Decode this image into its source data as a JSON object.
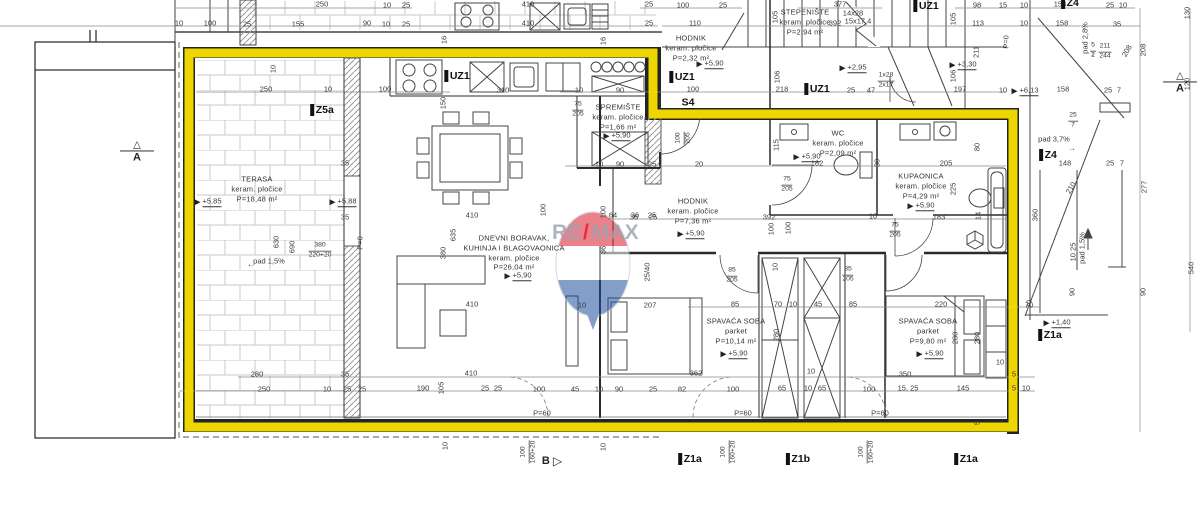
{
  "watermark": {
    "re": "RE",
    "slash": "/",
    "max": "MAX",
    "red": "#dc1c2e",
    "blue": "#1d4f9e",
    "gray": "#9aa2ad"
  },
  "highlight_color": "#ffe600",
  "rooms": [
    {
      "x": 257,
      "y": 189,
      "lines": [
        "TERASA",
        "keram. pločice",
        "P=18,48 m²"
      ]
    },
    {
      "x": 514,
      "y": 253,
      "lines": [
        "DNEVNI BORAVAK,",
        "KUHINJA I BLAGOVAONICA",
        "keram. pločice",
        "P=26,04 m²"
      ]
    },
    {
      "x": 618,
      "y": 117,
      "lines": [
        "SPREMIŠTE",
        "keram. pločice",
        "P=1,66 m²"
      ]
    },
    {
      "x": 691,
      "y": 48,
      "lines": [
        "HODNIK",
        "keram. pločice",
        "P=2,32 m²"
      ]
    },
    {
      "x": 693,
      "y": 211,
      "lines": [
        "HODNIK",
        "keram. pločice",
        "P=7,36 m²"
      ]
    },
    {
      "x": 838,
      "y": 143,
      "lines": [
        "WC",
        "keram. pločice",
        "P=2,09 m²"
      ]
    },
    {
      "x": 921,
      "y": 186,
      "lines": [
        "KUPAONICA",
        "keram. pločice",
        "P=4,29 m²"
      ]
    },
    {
      "x": 736,
      "y": 331,
      "lines": [
        "SPAVAĆA SOBA",
        "parket",
        "P=10,14 m²"
      ]
    },
    {
      "x": 928,
      "y": 331,
      "lines": [
        "SPAVAĆA SOBA",
        "parket",
        "P=9,80 m²"
      ]
    },
    {
      "x": 805,
      "y": 22,
      "lines": [
        "STEPENIŠTE",
        "keram. pločice",
        "P=2,94 m²"
      ]
    }
  ],
  "levels": [
    {
      "t": "+5,85",
      "x": 208,
      "y": 202
    },
    {
      "t": "+5,88",
      "x": 343,
      "y": 202
    },
    {
      "t": "+5,90",
      "x": 518,
      "y": 276
    },
    {
      "t": "+5,90",
      "x": 617,
      "y": 136
    },
    {
      "t": "+5,90",
      "x": 710,
      "y": 64
    },
    {
      "t": "+5,90",
      "x": 691,
      "y": 234
    },
    {
      "t": "+5,90",
      "x": 807,
      "y": 157
    },
    {
      "t": "+5,90",
      "x": 921,
      "y": 206
    },
    {
      "t": "+5,90",
      "x": 734,
      "y": 354
    },
    {
      "t": "+5,90",
      "x": 930,
      "y": 354
    },
    {
      "t": "+2,95",
      "x": 853,
      "y": 68
    },
    {
      "t": "+3,30",
      "x": 963,
      "y": 65
    },
    {
      "t": "+6,13",
      "x": 1025,
      "y": 91
    },
    {
      "t": "+1,40",
      "x": 1057,
      "y": 323
    }
  ],
  "dims": [
    {
      "t": "250",
      "x": 322,
      "y": 4
    },
    {
      "t": "10",
      "x": 387,
      "y": 5
    },
    {
      "t": "25",
      "x": 406,
      "y": 5
    },
    {
      "t": "410",
      "x": 528,
      "y": 4
    },
    {
      "t": "25",
      "x": 649,
      "y": 4
    },
    {
      "t": "100",
      "x": 683,
      "y": 5
    },
    {
      "t": "25",
      "x": 723,
      "y": 5
    },
    {
      "t": "377",
      "x": 840,
      "y": 4
    },
    {
      "t": "14x28",
      "x": 853,
      "y": 13
    },
    {
      "t": "98",
      "x": 977,
      "y": 5
    },
    {
      "t": "15",
      "x": 1003,
      "y": 5
    },
    {
      "t": "10",
      "x": 1024,
      "y": 5
    },
    {
      "t": "158",
      "x": 1060,
      "y": 4
    },
    {
      "t": "25",
      "x": 1110,
      "y": 5
    },
    {
      "t": "10",
      "x": 1123,
      "y": 5
    },
    {
      "t": "10",
      "x": 179,
      "y": 23
    },
    {
      "t": "100",
      "x": 210,
      "y": 23
    },
    {
      "t": "25",
      "x": 247,
      "y": 24
    },
    {
      "t": "155",
      "x": 298,
      "y": 24
    },
    {
      "t": "90",
      "x": 367,
      "y": 23
    },
    {
      "t": "10",
      "x": 386,
      "y": 24
    },
    {
      "t": "25",
      "x": 406,
      "y": 24
    },
    {
      "t": "410",
      "x": 528,
      "y": 23
    },
    {
      "t": "25",
      "x": 649,
      "y": 23
    },
    {
      "t": "110",
      "x": 695,
      "y": 23
    },
    {
      "t": "392",
      "x": 835,
      "y": 23
    },
    {
      "t": "15x17,4",
      "x": 858,
      "y": 21
    },
    {
      "t": "113",
      "x": 978,
      "y": 23
    },
    {
      "t": "10",
      "x": 1024,
      "y": 23
    },
    {
      "t": "158",
      "x": 1062,
      "y": 23
    },
    {
      "t": "35",
      "x": 1117,
      "y": 24
    },
    {
      "t": "16",
      "x": 444,
      "y": 40,
      "r": -90
    },
    {
      "t": "16",
      "x": 603,
      "y": 41,
      "r": -90
    },
    {
      "t": "105",
      "x": 775,
      "y": 17,
      "r": -90
    },
    {
      "t": "105",
      "x": 953,
      "y": 19,
      "r": -90
    },
    {
      "t": "211",
      "x": 976,
      "y": 52,
      "r": -90
    },
    {
      "t": "P=0",
      "x": 1006,
      "y": 42,
      "r": -90
    },
    {
      "t": "208",
      "x": 1127,
      "y": 51,
      "r": -60
    },
    {
      "t": "pad 2,8%",
      "x": 1085,
      "y": 38,
      "r": -90
    },
    {
      "t": "↓",
      "x": 1093,
      "y": 54
    },
    {
      "t": "208",
      "x": 1143,
      "y": 50,
      "r": -90
    },
    {
      "t": "130",
      "x": 1187,
      "y": 13,
      "r": -90
    },
    {
      "t": "120",
      "x": 1187,
      "y": 84,
      "r": -90
    },
    {
      "t": "106",
      "x": 777,
      "y": 77,
      "r": -90
    },
    {
      "t": "218",
      "x": 782,
      "y": 89
    },
    {
      "t": "25",
      "x": 851,
      "y": 90
    },
    {
      "t": "47",
      "x": 871,
      "y": 90
    },
    {
      "t": "106",
      "x": 953,
      "y": 76,
      "r": -90
    },
    {
      "t": "197",
      "x": 960,
      "y": 89
    },
    {
      "t": "100",
      "x": 693,
      "y": 89
    },
    {
      "t": "10",
      "x": 273,
      "y": 69,
      "r": -90
    },
    {
      "t": "250",
      "x": 266,
      "y": 89
    },
    {
      "t": "10",
      "x": 328,
      "y": 89
    },
    {
      "t": "100",
      "x": 385,
      "y": 89
    },
    {
      "t": "150",
      "x": 443,
      "y": 103,
      "r": -90
    },
    {
      "t": "310",
      "x": 503,
      "y": 90
    },
    {
      "t": "10",
      "x": 579,
      "y": 90
    },
    {
      "t": "90",
      "x": 620,
      "y": 90
    },
    {
      "t": "35",
      "x": 345,
      "y": 163
    },
    {
      "t": "35",
      "x": 345,
      "y": 217
    },
    {
      "t": "630",
      "x": 276,
      "y": 242,
      "r": -90
    },
    {
      "t": "690",
      "x": 292,
      "y": 247,
      "r": -90
    },
    {
      "t": "pad 1,5%",
      "x": 269,
      "y": 261
    },
    {
      "t": "←",
      "x": 251,
      "y": 264
    },
    {
      "t": "P=0",
      "x": 360,
      "y": 243,
      "r": -90
    },
    {
      "t": "410",
      "x": 472,
      "y": 215
    },
    {
      "t": "100",
      "x": 543,
      "y": 210,
      "r": -90
    },
    {
      "t": "635",
      "x": 453,
      "y": 235,
      "r": -90
    },
    {
      "t": "380",
      "x": 443,
      "y": 253,
      "r": -90
    },
    {
      "t": "100",
      "x": 603,
      "y": 212,
      "r": -90
    },
    {
      "t": "64",
      "x": 613,
      "y": 215
    },
    {
      "t": "36",
      "x": 635,
      "y": 215
    },
    {
      "t": "25",
      "x": 652,
      "y": 215
    },
    {
      "t": "36",
      "x": 603,
      "y": 250,
      "r": -90
    },
    {
      "t": "25/40",
      "x": 647,
      "y": 272,
      "r": -90
    },
    {
      "t": "410",
      "x": 472,
      "y": 304
    },
    {
      "t": "10",
      "x": 582,
      "y": 305
    },
    {
      "t": "207",
      "x": 650,
      "y": 305
    },
    {
      "t": "10",
      "x": 599,
      "y": 164
    },
    {
      "t": "90",
      "x": 620,
      "y": 164
    },
    {
      "t": "25",
      "x": 652,
      "y": 164
    },
    {
      "t": "20",
      "x": 699,
      "y": 164
    },
    {
      "t": "36",
      "x": 634,
      "y": 217
    },
    {
      "t": "25",
      "x": 653,
      "y": 217
    },
    {
      "t": "392",
      "x": 769,
      "y": 217
    },
    {
      "t": "100",
      "x": 788,
      "y": 228,
      "r": -90
    },
    {
      "t": "10",
      "x": 775,
      "y": 267,
      "r": -90
    },
    {
      "t": "115",
      "x": 776,
      "y": 145,
      "r": -90
    },
    {
      "t": "182",
      "x": 817,
      "y": 163
    },
    {
      "t": "30",
      "x": 877,
      "y": 163,
      "r": -90
    },
    {
      "t": "205",
      "x": 946,
      "y": 163
    },
    {
      "t": "183",
      "x": 939,
      "y": 217
    },
    {
      "t": "225",
      "x": 953,
      "y": 189,
      "r": -90
    },
    {
      "t": "80",
      "x": 977,
      "y": 147,
      "r": -90
    },
    {
      "t": "10",
      "x": 873,
      "y": 216
    },
    {
      "t": "100",
      "x": 771,
      "y": 229,
      "r": -90
    },
    {
      "t": "14",
      "x": 978,
      "y": 216,
      "r": -90
    },
    {
      "t": "85",
      "x": 735,
      "y": 304
    },
    {
      "t": "70",
      "x": 778,
      "y": 304
    },
    {
      "t": "10",
      "x": 793,
      "y": 304
    },
    {
      "t": "45",
      "x": 818,
      "y": 304
    },
    {
      "t": "85",
      "x": 853,
      "y": 304
    },
    {
      "t": "220",
      "x": 941,
      "y": 304
    },
    {
      "t": "70",
      "x": 1029,
      "y": 304,
      "r": -90
    },
    {
      "t": "280",
      "x": 776,
      "y": 335,
      "r": -90
    },
    {
      "t": "280",
      "x": 955,
      "y": 338,
      "r": -90
    },
    {
      "t": "280",
      "x": 977,
      "y": 338,
      "r": -90
    },
    {
      "t": "10",
      "x": 811,
      "y": 371
    },
    {
      "t": "10",
      "x": 1000,
      "y": 362
    },
    {
      "t": "362",
      "x": 696,
      "y": 373
    },
    {
      "t": "350",
      "x": 905,
      "y": 374
    },
    {
      "t": "5",
      "x": 1014,
      "y": 374
    },
    {
      "t": "10",
      "x": 1003,
      "y": 90
    },
    {
      "t": "158",
      "x": 1063,
      "y": 89
    },
    {
      "t": "25",
      "x": 1108,
      "y": 90
    },
    {
      "t": "7",
      "x": 1119,
      "y": 90
    },
    {
      "t": "pad 3,7%",
      "x": 1054,
      "y": 139
    },
    {
      "t": "→",
      "x": 1072,
      "y": 148
    },
    {
      "t": "148",
      "x": 1065,
      "y": 163
    },
    {
      "t": "25",
      "x": 1110,
      "y": 163
    },
    {
      "t": "7",
      "x": 1122,
      "y": 163
    },
    {
      "t": "210",
      "x": 1071,
      "y": 188,
      "r": -60
    },
    {
      "t": "277",
      "x": 1144,
      "y": 187,
      "r": -90
    },
    {
      "t": "360",
      "x": 1035,
      "y": 215,
      "r": -90
    },
    {
      "t": "10  25",
      "x": 1073,
      "y": 252,
      "r": -90
    },
    {
      "t": "pad 1,5%",
      "x": 1082,
      "y": 248,
      "r": -90
    },
    {
      "t": "↑",
      "x": 1089,
      "y": 232
    },
    {
      "t": "90",
      "x": 1072,
      "y": 292,
      "r": -90
    },
    {
      "t": "90",
      "x": 1143,
      "y": 292,
      "r": -90
    },
    {
      "t": "540",
      "x": 1191,
      "y": 268,
      "r": -90
    },
    {
      "t": "70",
      "x": 1029,
      "y": 305
    },
    {
      "t": "280",
      "x": 257,
      "y": 374
    },
    {
      "t": "35",
      "x": 345,
      "y": 374
    },
    {
      "t": "410",
      "x": 471,
      "y": 373
    },
    {
      "t": "250",
      "x": 264,
      "y": 389
    },
    {
      "t": "10",
      "x": 327,
      "y": 389
    },
    {
      "t": "25",
      "x": 347,
      "y": 389
    },
    {
      "t": "25",
      "x": 362,
      "y": 389
    },
    {
      "t": "190",
      "x": 423,
      "y": 388
    },
    {
      "t": "105",
      "x": 441,
      "y": 388,
      "r": -90
    },
    {
      "t": "10",
      "x": 445,
      "y": 446,
      "r": -90
    },
    {
      "t": "25",
      "x": 485,
      "y": 388
    },
    {
      "t": "25",
      "x": 498,
      "y": 388
    },
    {
      "t": "100",
      "x": 539,
      "y": 389
    },
    {
      "t": "45",
      "x": 575,
      "y": 389
    },
    {
      "t": "10",
      "x": 599,
      "y": 389
    },
    {
      "t": "90",
      "x": 619,
      "y": 389
    },
    {
      "t": "25",
      "x": 653,
      "y": 389
    },
    {
      "t": "82",
      "x": 682,
      "y": 389
    },
    {
      "t": "100",
      "x": 733,
      "y": 389
    },
    {
      "t": "65",
      "x": 782,
      "y": 388
    },
    {
      "t": "10",
      "x": 808,
      "y": 388
    },
    {
      "t": "65",
      "x": 822,
      "y": 388
    },
    {
      "t": "100",
      "x": 869,
      "y": 389
    },
    {
      "t": "15, 25",
      "x": 908,
      "y": 388
    },
    {
      "t": "145",
      "x": 963,
      "y": 388
    },
    {
      "t": "5",
      "x": 1014,
      "y": 388
    },
    {
      "t": "10",
      "x": 1026,
      "y": 388
    },
    {
      "t": "10",
      "x": 603,
      "y": 447,
      "r": -90
    },
    {
      "t": "5",
      "x": 977,
      "y": 423,
      "r": -90
    },
    {
      "t": "P=60",
      "x": 542,
      "y": 413
    },
    {
      "t": "P=60",
      "x": 743,
      "y": 413
    },
    {
      "t": "P=60",
      "x": 880,
      "y": 413
    }
  ],
  "fracs": [
    {
      "top": "380",
      "bot": "220+20",
      "x": 320,
      "y": 251
    },
    {
      "top": "75",
      "bot": "205",
      "x": 578,
      "y": 110
    },
    {
      "top": "100",
      "bot": "205",
      "x": 684,
      "y": 138,
      "r": -90
    },
    {
      "top": "75",
      "bot": "205",
      "x": 787,
      "y": 185
    },
    {
      "top": "75",
      "bot": "205",
      "x": 895,
      "y": 231
    },
    {
      "top": "85",
      "bot": "205",
      "x": 732,
      "y": 276
    },
    {
      "top": "85",
      "bot": "205",
      "x": 848,
      "y": 275
    },
    {
      "top": "1x28",
      "bot": "2x17",
      "x": 886,
      "y": 81
    },
    {
      "top": "211",
      "bot": "244",
      "x": 1105,
      "y": 52
    },
    {
      "top": "5",
      "bot": "2",
      "x": 1093,
      "y": 51
    },
    {
      "top": "25",
      "bot": "7",
      "x": 1073,
      "y": 121
    },
    {
      "top": "100",
      "bot": "160+20",
      "x": 529,
      "y": 452,
      "r": -90
    },
    {
      "top": "100",
      "bot": "160+20",
      "x": 729,
      "y": 452,
      "r": -90
    },
    {
      "top": "100",
      "bot": "160+20",
      "x": 867,
      "y": 452,
      "r": -90
    }
  ],
  "marks": [
    {
      "t": "Z5a",
      "x": 322,
      "y": 110,
      "bar": true
    },
    {
      "t": "UZ1",
      "x": 457,
      "y": 76,
      "bar": true
    },
    {
      "t": "UZ1",
      "x": 682,
      "y": 77,
      "bar": true
    },
    {
      "t": "UZ1",
      "x": 817,
      "y": 89,
      "bar": true
    },
    {
      "t": "UZ1",
      "x": 926,
      "y": 6,
      "bar": true
    },
    {
      "t": "Z4",
      "x": 1070,
      "y": 3,
      "bar": true
    },
    {
      "t": "Z4",
      "x": 1048,
      "y": 155,
      "bar": true
    },
    {
      "t": "Z1a",
      "x": 1050,
      "y": 335,
      "bar": true
    },
    {
      "t": "Z1a",
      "x": 690,
      "y": 459,
      "bar": true
    },
    {
      "t": "Z1b",
      "x": 798,
      "y": 459,
      "bar": true
    },
    {
      "t": "Z1a",
      "x": 966,
      "y": 459,
      "bar": true
    },
    {
      "t": "S4",
      "x": 688,
      "y": 103,
      "bar": false,
      "u": true
    }
  ],
  "sections": [
    {
      "t": "A",
      "x": 137,
      "y": 152,
      "kind": "tri-up"
    },
    {
      "t": "A",
      "x": 1180,
      "y": 83,
      "kind": "tri-up"
    },
    {
      "t": "B",
      "x": 552,
      "y": 461,
      "kind": "tri-right"
    }
  ]
}
